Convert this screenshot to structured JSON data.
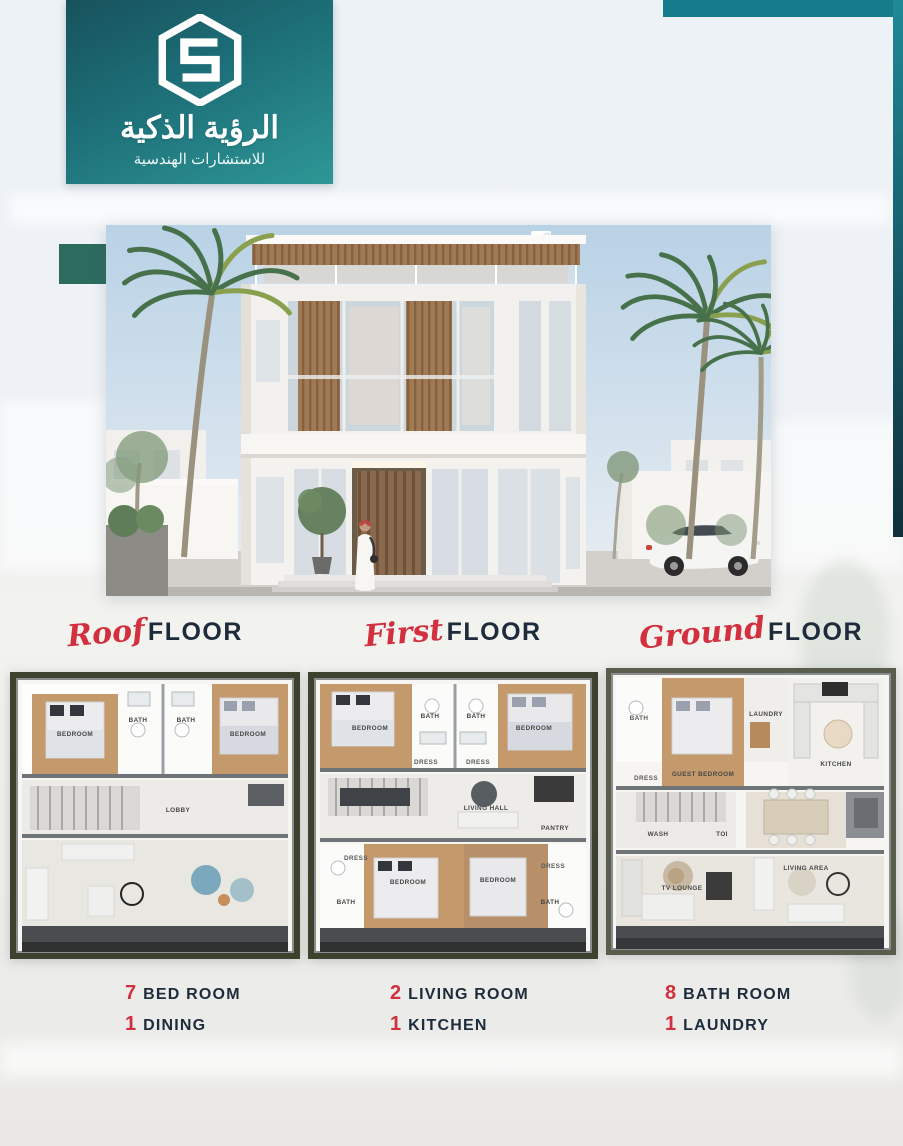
{
  "logo": {
    "title": "الرؤية الذكية",
    "subtitle": "للاستشارات الهندسية"
  },
  "floor_labels": [
    {
      "script": "Roof",
      "word": "FLOOR"
    },
    {
      "script": "First",
      "word": "FLOOR"
    },
    {
      "script": "Ground",
      "word": "FLOOR"
    }
  ],
  "plans": {
    "roof": {
      "rooms": [
        "BEDROOM",
        "BATH",
        "BATH",
        "BEDROOM",
        "LOBBY"
      ]
    },
    "first": {
      "rooms": [
        "BEDROOM",
        "BATH",
        "BATH",
        "BEDROOM",
        "DRESS",
        "DRESS",
        "LIVING HALL",
        "PANTRY",
        "DRESS",
        "BEDROOM",
        "BEDROOM",
        "DRESS",
        "BATH",
        "BATH"
      ]
    },
    "ground": {
      "rooms": [
        "BATH",
        "GUEST BEDROOM",
        "LAUNDRY",
        "KITCHEN",
        "DRESS",
        "WASH",
        "TOI",
        "TV LOUNGE",
        "LIVING AREA"
      ]
    }
  },
  "stats_columns": [
    {
      "items": [
        {
          "count": "7",
          "label": "BED ROOM"
        },
        {
          "count": "1",
          "label": "DINING"
        }
      ]
    },
    {
      "items": [
        {
          "count": "2",
          "label": "LIVING ROOM"
        },
        {
          "count": "1",
          "label": "KITCHEN"
        }
      ]
    },
    {
      "items": [
        {
          "count": "8",
          "label": "BATH ROOM"
        },
        {
          "count": "1",
          "label": "LAUNDRY"
        }
      ]
    }
  ],
  "colors": {
    "teal": "#1f7a82",
    "teal_dark": "#11404c",
    "accent_red": "#d2303e",
    "navy": "#1d2b3a"
  }
}
